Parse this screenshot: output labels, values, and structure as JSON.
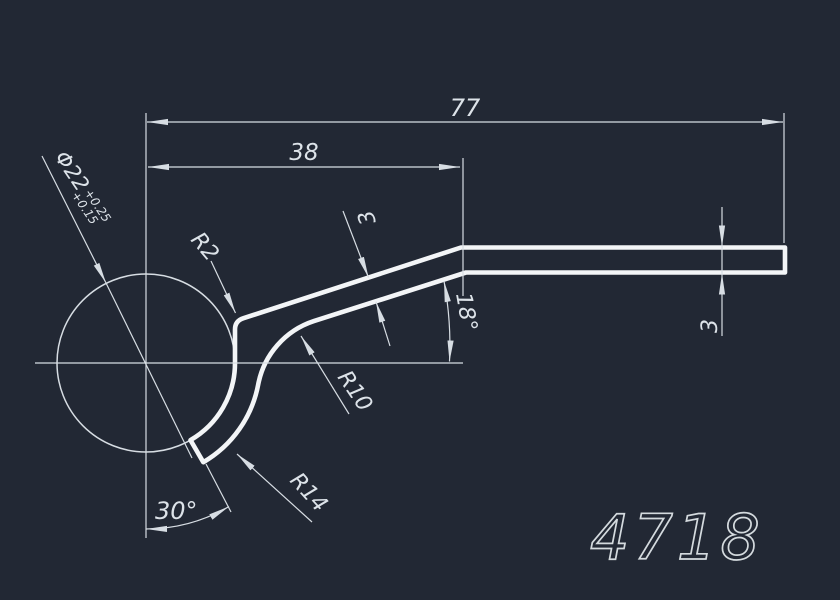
{
  "window": {
    "background": "#222834"
  },
  "palette": {
    "line": "#d7dde3",
    "profile": "#f3f5f7",
    "text": "#dde3e9"
  },
  "dims": {
    "overall_length": "77",
    "length_to_bend": "38",
    "bore_diameter": "Φ22",
    "bore_tol_upper": "+0.25",
    "bore_tol_lower": "+0.15",
    "corner_radius": "R2",
    "inner_bend_radius": "R10",
    "outer_hook_radius": "R14",
    "thickness_mid": "3",
    "thickness_end": "3",
    "slope_angle": "18°",
    "end_cut_angle": "30°"
  },
  "title_block": {
    "part_number": "4718"
  }
}
